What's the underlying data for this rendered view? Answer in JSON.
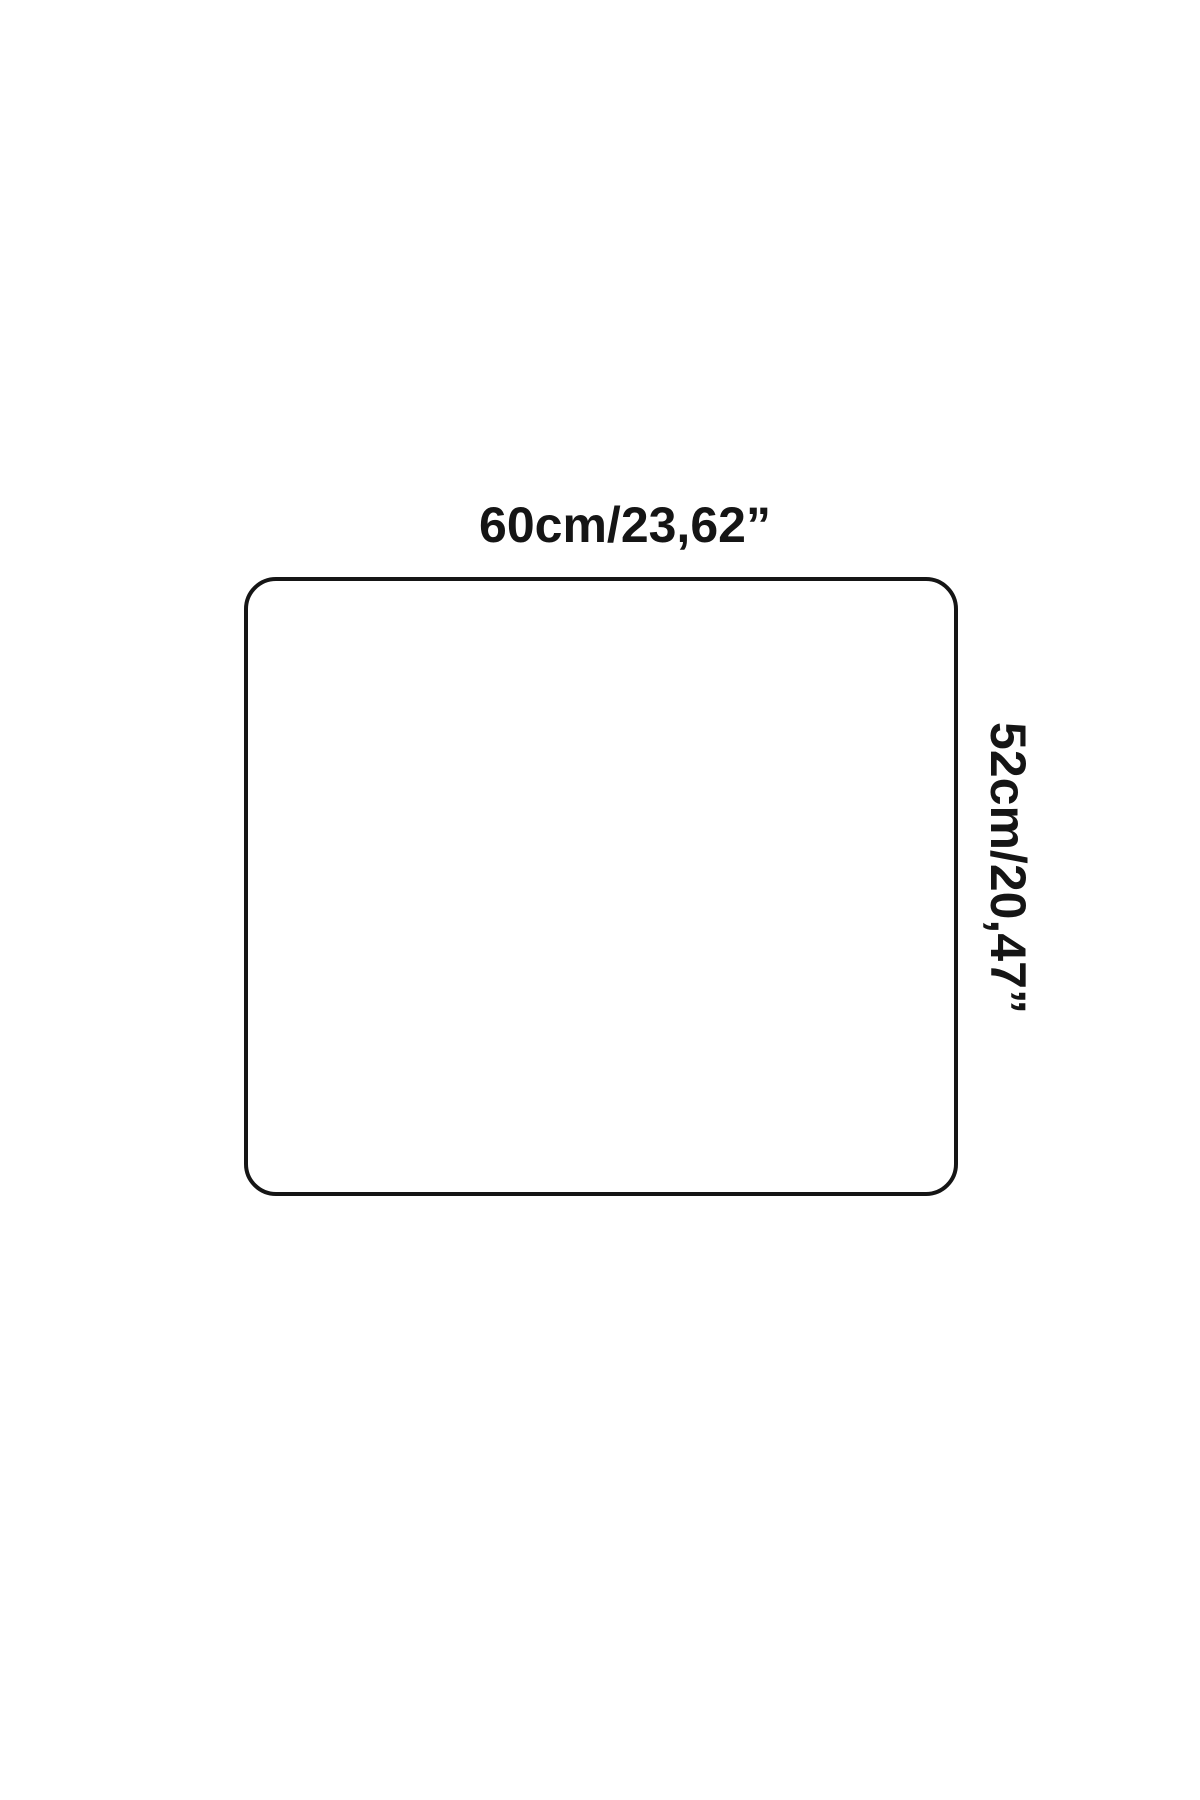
{
  "diagram": {
    "type": "product-dimension-diagram",
    "shape": "rounded-rectangle",
    "width_label": "60cm/23,62”",
    "height_label": "52cm/20,47”",
    "outline_color": "#151515",
    "text_color": "#151515",
    "background_color": "#ffffff"
  }
}
